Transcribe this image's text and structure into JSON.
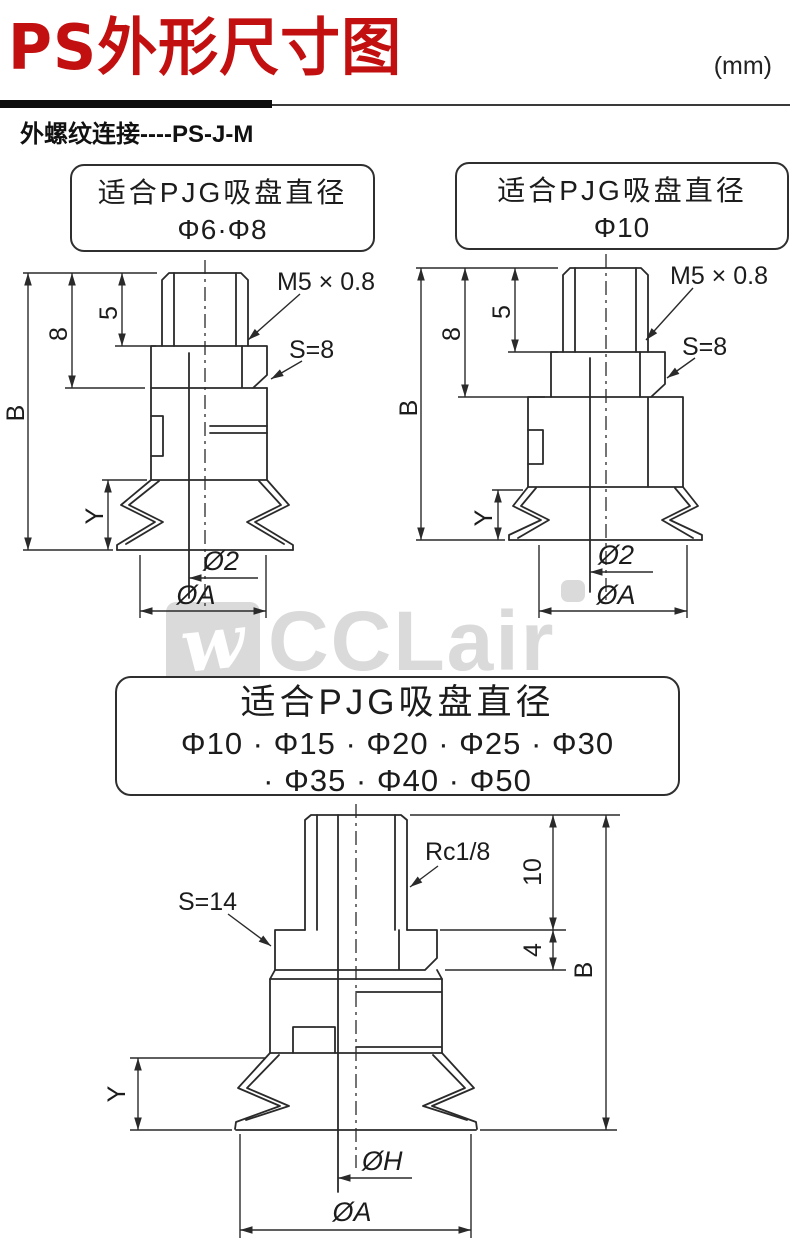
{
  "header": {
    "title": "PS外形尺寸图",
    "unit": "(mm)",
    "subtitle": "外螺纹连接----PS-J-M"
  },
  "callout_small_1": {
    "line1": "适合PJG吸盘直径",
    "line2": "Φ6·Φ8"
  },
  "callout_small_2": {
    "line1": "适合PJG吸盘直径",
    "line2": "Φ10"
  },
  "callout_large": {
    "line1": "适合PJG吸盘直径",
    "line2": "Φ10 · Φ15 · Φ20 · Φ25 · Φ30",
    "line3": "· Φ35 · Φ40 · Φ50"
  },
  "drawing_left": {
    "thread_label": "M5 × 0.8",
    "wrench_label": "S=8",
    "dim_overall": "B",
    "dim_shank": "8",
    "dim_thread": "5",
    "dim_bellows": "Y",
    "dia_orifice": "Ø2",
    "dia_cup": "ØA"
  },
  "drawing_right": {
    "thread_label": "M5 × 0.8",
    "wrench_label": "S=8",
    "dim_overall": "B",
    "dim_shank": "8",
    "dim_thread": "5",
    "dim_bellows": "Y",
    "dia_orifice": "Ø2",
    "dia_cup": "ØA"
  },
  "drawing_bottom": {
    "thread_label": "Rc1/8",
    "wrench_label": "S=14",
    "dim_thread_len": "10",
    "dim_hex_h": "4",
    "dim_overall": "B",
    "dim_bellows": "Y",
    "dia_hole": "ØH",
    "dia_cup": "ØA"
  },
  "watermark": {
    "logo_glyph": "w",
    "brand": "CCLair"
  },
  "colors": {
    "accent": "#c21010",
    "line": "#2a2a2a",
    "watermark": "#dadada"
  }
}
